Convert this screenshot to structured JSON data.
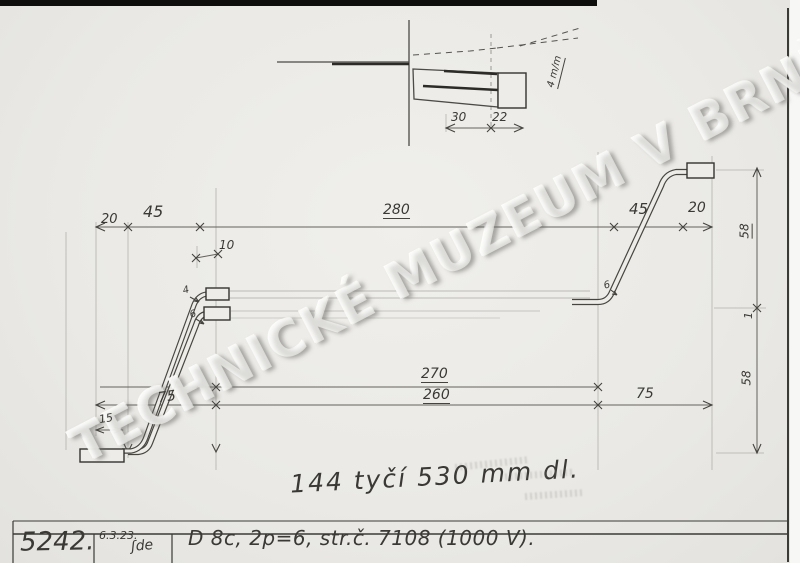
{
  "watermark": {
    "text": "TECHNICKÉ MUZEUM V BRNĚ"
  },
  "detail": {
    "dim_30": "30",
    "dim_22": "22",
    "diameter_label": "4 m/m"
  },
  "dims": {
    "left_20": "20",
    "left_45": "45",
    "offset_10": "10",
    "total_280": "280",
    "right_45": "45",
    "right_20": "20",
    "total_270": "270",
    "total_260": "260",
    "left_75": "75",
    "right_75": "75",
    "left_15": "15",
    "side_58_top": "58",
    "side_1": "1",
    "side_58_bottom": "58",
    "callout_4": "4",
    "callout_6_left": "6",
    "callout_6_right": "6"
  },
  "notes": {
    "quantity": "144 tyčí 530 mm dl."
  },
  "title_block": {
    "inventory_number": "5242.",
    "date": "6.3.23.",
    "signature": "ʃde",
    "description": "D 8c, 2p=6, str.č. 7108 (1000 V)."
  }
}
